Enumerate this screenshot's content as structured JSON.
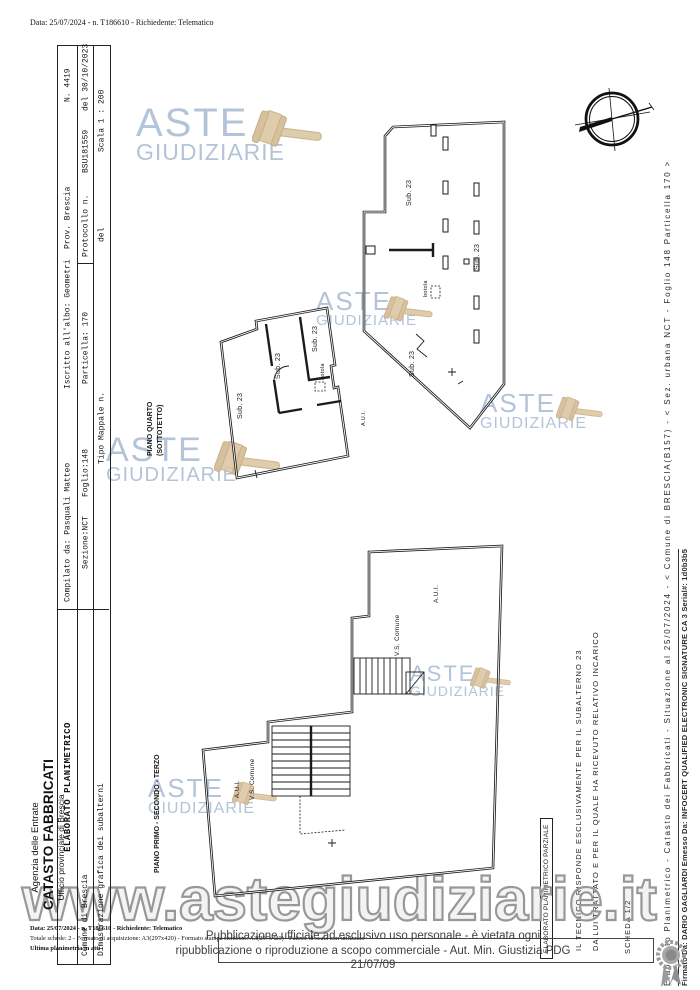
{
  "doc": {
    "request_line": "Data: 25/07/2024 - n. T186610 - Richiedente: Telematico",
    "footer": {
      "line1": "Data: 25/07/2024 - n. T186610 - Richiedente: Telematico",
      "line2": "Totale schede: 2 - Formato di acquisizione: A3(297x420)  - Formato stampa richiesto: A3(297x420) - Fattore di scala non utilizzato",
      "line3": "Ultima planimetria in atti"
    }
  },
  "agency": {
    "line1": "Agenzia delle Entrate",
    "line2": "CATASTO FABBRICATI",
    "line3": "Ufficio provinciale di  Brescia"
  },
  "table": {
    "r1c1": "ELABORATO PLANIMETRICO",
    "r1c2": "Compilato da: Pasquali Matteo",
    "r1c3": "Iscritto all'albo: Geometri",
    "r1c4": "Prov. Brescia",
    "r1c5": "N. 4419",
    "r2c1": "Comune di Brescia",
    "r2c2": "Sezione:NCT    Foglio:148",
    "r2c3": "Particella: 170",
    "r2c4": "Protocollo n.",
    "r2c5": "BSU181559",
    "r2c6": "del 30/10/2023",
    "r3c1": "Dimostrazione grafica dei subalterni",
    "r3c2": "Tipo Mappale n.",
    "r3c3": "del",
    "r3c4": "Scala 1 : 200"
  },
  "floors": {
    "upper1": "PIANO QUARTO",
    "upper2": "(SOTTOTETTO)",
    "lower": "PIANO PRIMO - SECONDO - TERZO"
  },
  "labels": {
    "sub23": "Sub. 23",
    "botola": "botola",
    "aui": "A.U.I.",
    "vs_comune": "V.S. Comune"
  },
  "legal": {
    "line1": "Pubblicazione ufficiale ad esclusivo uso personale - è vietata ogni",
    "line2": "ripubblicazione o riproduzione a scopo commerciale - Aut. Min. Giustizia PDG 21/07/09"
  },
  "margin": {
    "doc_info": "Elaborato Planimetrico - Catasto dei Fabbricati - Situazione al 25/07/2024 - < Comune di BRESCIA(B157) - < Sez. urbana NCT - Foglio 148 Particella 170 >",
    "signature": "Firmato Da: DARIO GAGLIARDI Emesso Da: INFOCERT QUALIFIED ELECTRONIC SIGNATURE CA 3 Serial#: 1d0b3b5"
  },
  "partial": {
    "boxed": "ELABORATO PLANIMETRICO PARZIALE",
    "line1": "IL TECNICO RISPONDE ESCLUSIVAMENTE PER IL SUBALTERNO 23",
    "line2": "DA LUI TRATTATO E PER IL QUALE HA RICEVUTO RELATIVO INCARICO",
    "sheet": "SCHEDA 1/2"
  },
  "watermark": {
    "aste": "ASTE",
    "giudiziarie": "GIUDIZIARIE",
    "url": "www.astegiudiziarie.it",
    "blue": "#b4c4d8",
    "tan": "#dcc8a6"
  }
}
